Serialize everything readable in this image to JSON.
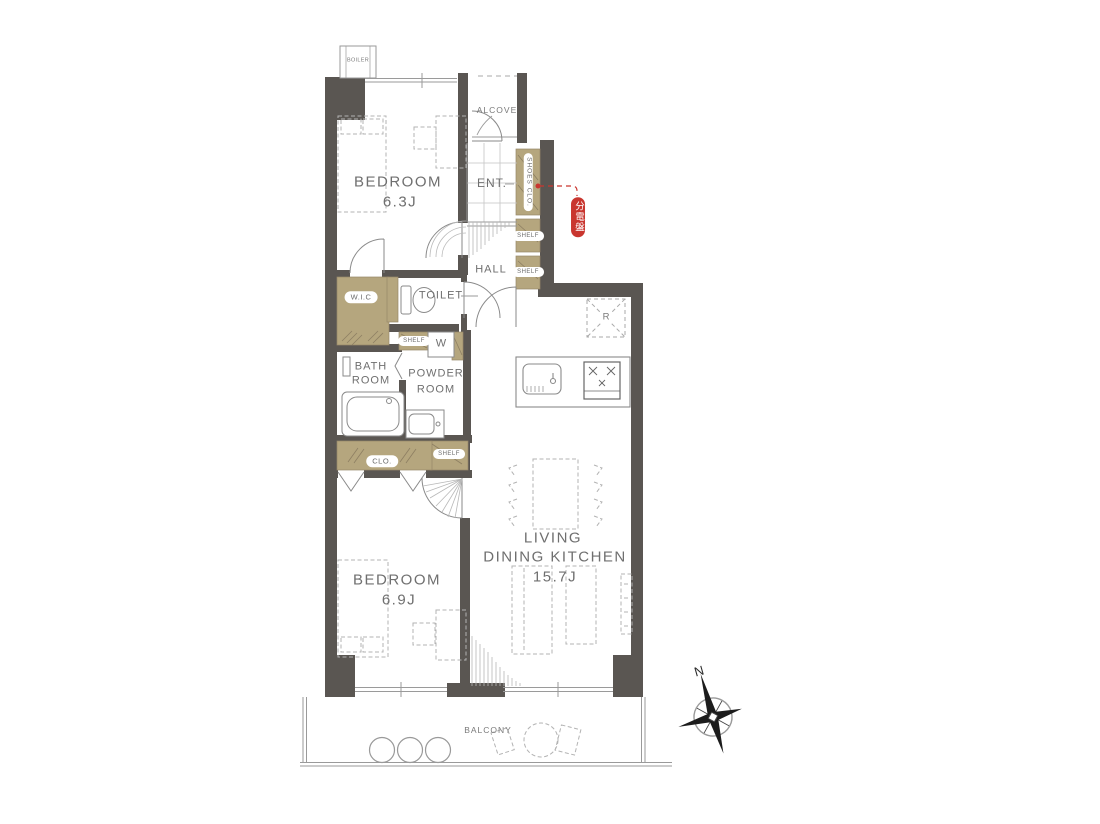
{
  "colors": {
    "wall": "#5a5652",
    "storage_tan": "#b5a67e",
    "accent_red": "#c9362f",
    "line_gray": "#9a9a9a",
    "text_gray": "#757575"
  },
  "rooms": {
    "bedroom1": {
      "name": "BEDROOM",
      "size": "6.3J"
    },
    "bedroom2": {
      "name": "BEDROOM",
      "size": "6.9J"
    },
    "ldk": {
      "name_line1": "LIVING",
      "name_line2": "DINING KITCHEN",
      "size": "15.7J"
    },
    "entrance": "ENT.",
    "alcove": "ALCOVE",
    "hall": "HALL",
    "toilet": "TOILET",
    "wic": "W.I.C",
    "bath_line1": "BATH",
    "bath_line2": "ROOM",
    "powder_line1": "POWDER",
    "powder_line2": "ROOM",
    "balcony": "BALCONY"
  },
  "fixtures": {
    "boiler": "BOILER",
    "shoes_closet": "SHOES CLO.",
    "shelf": "SHELF",
    "closet": "CLO.",
    "washer": "W",
    "refrigerator": "R",
    "distribution_board": "分電盤"
  },
  "compass": {
    "north": "N"
  }
}
